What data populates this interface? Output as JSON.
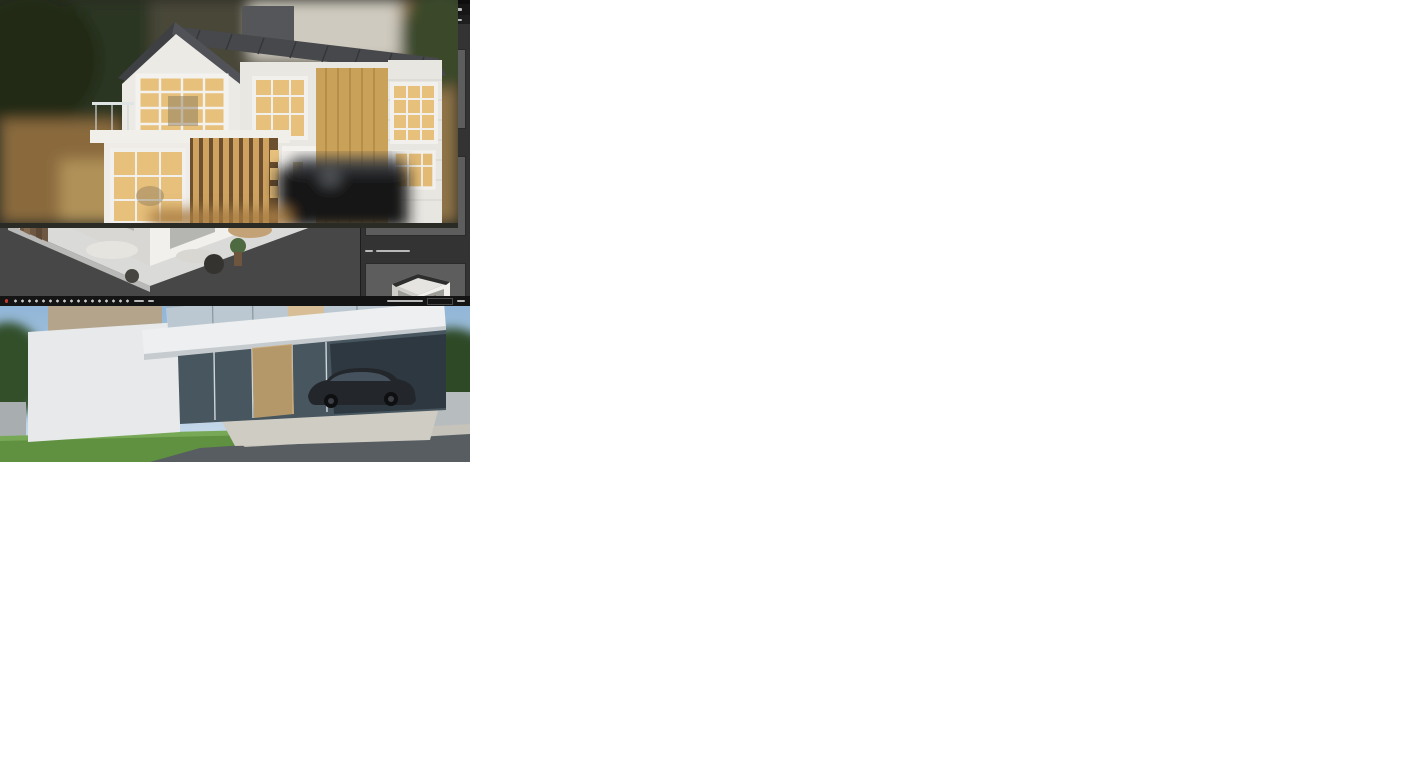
{
  "workflow": {
    "title": "Project Wofltfiow",
    "timeline": {
      "segment_colors": [
        "#8ab55a",
        "#4b87c6",
        "#e07b39",
        "#c9ced4",
        "#d96f2e"
      ],
      "node_colors": [
        "#69a244",
        "#4178b5",
        "#4178b5",
        "#b5372a",
        "#cc4125",
        "#cc4125",
        "#c0392b",
        "#b9cad7",
        "#992f22"
      ],
      "milestone_count": 9
    },
    "box_colors": {
      "blue": "#3d85c6",
      "orange": "#e8913c",
      "gray": "#f4f4f4"
    }
  },
  "panels": {
    "exterior_render": {
      "description": "photo render of modern multi-storey house"
    },
    "section_drawing": {
      "description": "dimensioned construction section drawing"
    },
    "wiring_plan_top": {
      "description": "floor plan with electrical wiring, red circuits"
    },
    "bim_app": {
      "description": "dark 3D BIM software with isometric cutaway model"
    },
    "wiring_plan_mid": {
      "description": "dense electrical floor plan with red circuit runs"
    },
    "dollhouse_app": {
      "description": "dark 3D software, two-storey dollhouse cutaway"
    },
    "workflow_diagram": {
      "description": "project workflow timeline with blue and orange task boxes"
    },
    "model_photo": {
      "description": "physical architectural scale model photo"
    }
  },
  "colors": {
    "wire_red": "#a83232",
    "wall_gray": "#4f4f4f",
    "selection_blue": "#3a6fae",
    "app_bg_dark": "#242424",
    "viewport_gray": "#7b7b7b"
  }
}
